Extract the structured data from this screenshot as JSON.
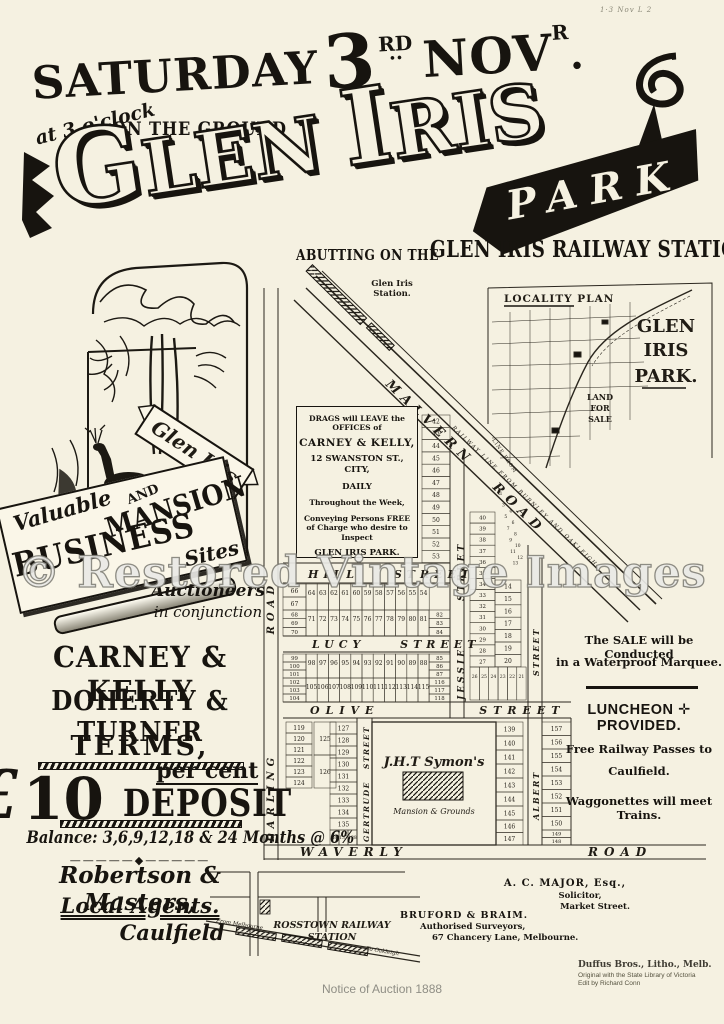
{
  "annotation": "1·3 Nov L 2",
  "watermark": "© Restored Vintage Images",
  "header": {
    "day": "SATURDAY",
    "date_num": "3",
    "date_ord": "RD",
    "date_dots": "··",
    "month": "NOV",
    "month_sup": "R",
    "month_dot": ".",
    "time": "at 3 o'clock",
    "ground": "ON THE GROUND",
    "title1": "G",
    "title2": "LEN",
    "title3": "I",
    "title4": "RIS",
    "park": "PARK",
    "abutting": "ABUTTING ON THE",
    "railway_station": "GLEN IRIS RAILWAY STATION"
  },
  "vignette": {
    "ribbon": "Glen Iris"
  },
  "banner": {
    "valuable": "Valuable",
    "business": "BUSINESS",
    "and": "AND",
    "mansion": "MANSION",
    "sites": "Sites"
  },
  "auction": {
    "line1": "Auctioneers",
    "line2": "in conjunction",
    "firm1": "CARNEY & KELLY",
    "firm2": "DOHERTY & TURNER",
    "terms": "TERMS,",
    "pound": "£",
    "ten": "10",
    "percent": "per cent",
    "deposit": "DEPOSIT",
    "balance": "Balance: 3,6,9,12,18 & 24 Months @ 6%",
    "ornament": "—————◆—————"
  },
  "agents": {
    "name": "Robertson & Masters,",
    "role": "Local Agents.",
    "place": "Caulfield"
  },
  "sale_info": {
    "l1": "The SALE will be Conducted",
    "l2": "in a Waterproof Marquee.",
    "luncheon": "LUNCHEON ✛ PROVIDED.",
    "rail1": "Free Railway Passes to",
    "rail2": "Caulfield.",
    "wagg": "Waggonettes will meet Trains."
  },
  "contacts": {
    "major1": "A. C. MAJOR, Esq.,",
    "major2": "Solicitor,",
    "major3": "Market Street.",
    "surv1": "BRUFORD & BRAIM.",
    "surv2": "Authorised Surveyors,",
    "surv3": "67 Chancery Lane, Melbourne."
  },
  "credits": {
    "litho": "Duffus Bros., Litho., Melb.",
    "orig": "Original with the State Library of Victoria",
    "edit": "Edit by Richard Conn",
    "notice": "Notice of Auction 1888"
  },
  "map": {
    "station1": "Glen Iris",
    "station2": "Station.",
    "malvern1": "MALVERN",
    "malvern2": "ROAD",
    "railway_line": "RAILWAY LINE FROM BURNLEY AND OAKLEIGH",
    "drags": [
      "DRAGS will LEAVE the",
      "OFFICES of",
      "CARNEY & KELLY,",
      "12 SWANSTON ST., CITY,",
      "DAILY",
      "Throughout the Week,",
      "Conveying Persons FREE",
      "of Charge who desire to",
      "Inspect",
      "GLEN IRIS PARK."
    ],
    "streets": {
      "hill": "HILL STREET",
      "lucy": "LUCY STREET",
      "olive": "OLIVE STREET",
      "waverly": "WAVERLY ROAD",
      "darling": "DARLING ROAD",
      "jessie": "JESSIE STREET",
      "gertrude": "GERTRUDE STREET",
      "albert": "ALBERT STREET"
    },
    "symons1": "J.H.T Symon's",
    "symons2": "Mansion & Grounds",
    "lots": {
      "strip": [
        "42",
        "43",
        "44",
        "45",
        "46",
        "47",
        "48",
        "49",
        "50",
        "51",
        "52",
        "53"
      ],
      "rowHillN": [
        "64",
        "63",
        "62",
        "61",
        "60",
        "59",
        "58",
        "57",
        "56",
        "55",
        "54"
      ],
      "stackA": [
        "66",
        "67"
      ],
      "stackB": [
        "68",
        "69",
        "70"
      ],
      "rowHillS": [
        "71",
        "72",
        "73",
        "74",
        "75",
        "76",
        "77",
        "78",
        "79",
        "80",
        "81"
      ],
      "stackC": [
        "82",
        "83",
        "84"
      ],
      "stackD": [
        "99",
        "100",
        "101"
      ],
      "rowLucyS": [
        "98",
        "97",
        "96",
        "95",
        "94",
        "93",
        "92",
        "91",
        "90",
        "89",
        "88"
      ],
      "stackE": [
        "85",
        "86",
        "87"
      ],
      "stackF": [
        "102",
        "103",
        "104"
      ],
      "rowOliveN": [
        "105",
        "106",
        "107",
        "108",
        "109",
        "110",
        "111",
        "112",
        "113",
        "114",
        "115"
      ],
      "stackG": [
        "116",
        "117",
        "118"
      ],
      "swCol": [
        "119",
        "120",
        "121",
        "122",
        "123",
        "124"
      ],
      "swPair": [
        "125",
        "126"
      ],
      "gertCol": [
        "127",
        "128",
        "129",
        "130",
        "131",
        "132",
        "133",
        "134",
        "135"
      ],
      "gertBottom": [
        "136",
        "137",
        "138"
      ],
      "albWCol": [
        "139",
        "140",
        "141",
        "142",
        "143",
        "144",
        "145"
      ],
      "albWBottom": [
        "146",
        "147"
      ],
      "albECol": [
        "157",
        "156",
        "155",
        "154",
        "153",
        "152",
        "151",
        "150"
      ],
      "albEBottom": [
        "149",
        "148"
      ],
      "jessW": [
        "40",
        "39",
        "38",
        "37",
        "36",
        "35",
        "34",
        "33",
        "32",
        "31",
        "30",
        "29",
        "28",
        "27"
      ],
      "jessE": [
        "14",
        "15",
        "16",
        "17",
        "18",
        "19",
        "20"
      ],
      "jessBottom": [
        "26",
        "25",
        "24",
        "23",
        "22",
        "21"
      ],
      "wedge": [
        "1",
        "2",
        "3",
        "4",
        "5",
        "6",
        "7",
        "8",
        "9",
        "10",
        "11",
        "12",
        "13"
      ]
    }
  },
  "locality": {
    "title": "LOCALITY PLAN",
    "g": "GLEN",
    "i": "IRIS",
    "p": "PARK.",
    "land": "LAND",
    "for": "FOR",
    "sale": "SALE",
    "line_from": "LINE FROM"
  },
  "bottom_map": {
    "road": "DANDENONG ROAD",
    "station1": "ROSSTOWN RAILWAY",
    "station2": "STATION",
    "from": "From Melbourne",
    "to": "To Oakleigh"
  },
  "colors": {
    "paper": "#f5f1e1",
    "ink": "#17140f",
    "gray_text": "#8f8e85"
  }
}
